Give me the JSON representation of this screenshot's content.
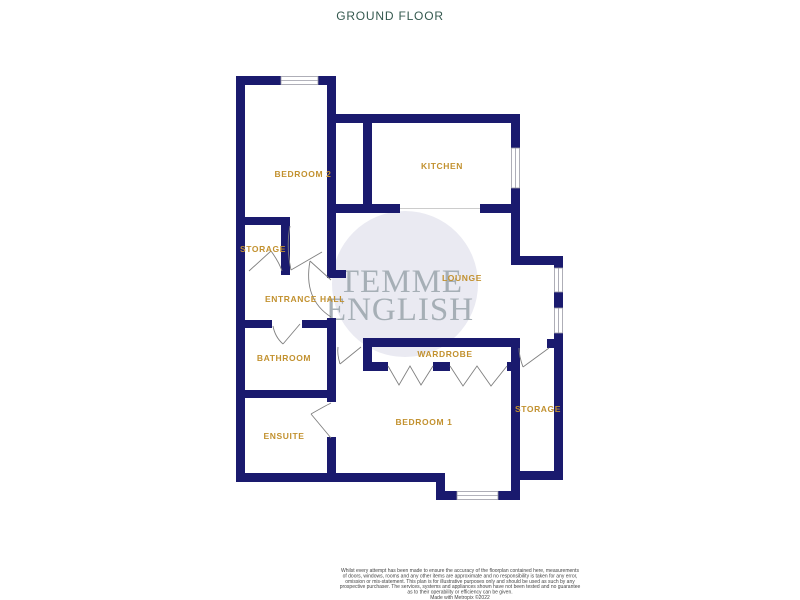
{
  "title": "GROUND FLOOR",
  "colors": {
    "wall_navy": "#1a1a6e",
    "room_label_gold": "#c2912f",
    "title_teal": "#35594f",
    "watermark_gray": "#a6afb6",
    "watermark_circle": "#eaeaf2"
  },
  "watermark": {
    "line1": "TEMME",
    "line2": "ENGLISH"
  },
  "plan": {
    "rooms": [
      {
        "id": "bedroom-2",
        "label": "BEDROOM 2"
      },
      {
        "id": "kitchen",
        "label": "KITCHEN"
      },
      {
        "id": "storage-left",
        "label": "STORAGE"
      },
      {
        "id": "entrance-hall",
        "label": "ENTRANCE HALL"
      },
      {
        "id": "lounge",
        "label": "LOUNGE"
      },
      {
        "id": "bathroom",
        "label": "BATHROOM"
      },
      {
        "id": "wardrobe",
        "label": "WARDROBE"
      },
      {
        "id": "ensuite",
        "label": "ENSUITE"
      },
      {
        "id": "bedroom-1",
        "label": "BEDROOM 1"
      },
      {
        "id": "storage-right",
        "label": "STORAGE"
      }
    ]
  },
  "disclaimer": {
    "lines": [
      "Whilst every attempt has been made to ensure the accuracy of the floorplan contained here, measurements",
      "of doors, windows, rooms and any other items are approximate and no responsibility is taken for any error,",
      "omission or mis-statement. This plan is for illustrative purposes only and should be used as such by any",
      "prospective purchaser. The services, systems and appliances shown have not been tested and no guarantee",
      "as to their operability or efficiency can be given.",
      "Made with Metropix ©2022"
    ]
  }
}
